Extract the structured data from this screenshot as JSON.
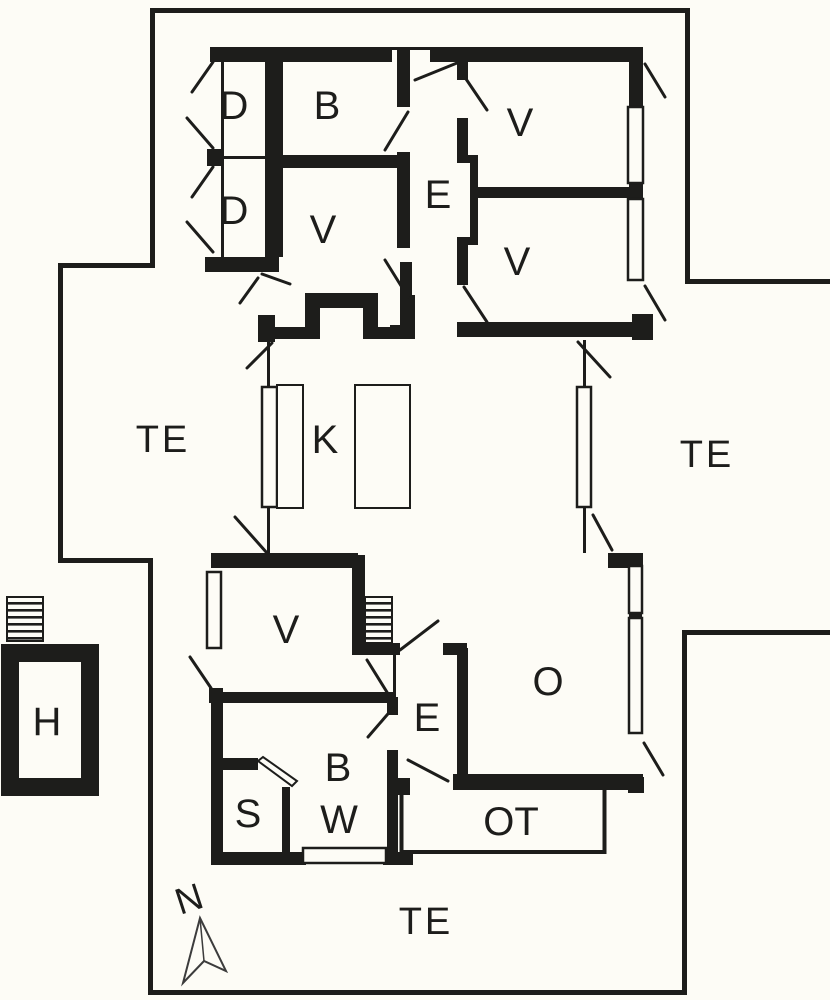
{
  "colors": {
    "ink": "#1d1d1b",
    "paper": "#fdfcf6"
  },
  "compass": {
    "label": "N"
  },
  "rooms": [
    {
      "key": "d1",
      "label": "D"
    },
    {
      "key": "d2",
      "label": "D"
    },
    {
      "key": "b1",
      "label": "B"
    },
    {
      "key": "v1",
      "label": "V"
    },
    {
      "key": "e1",
      "label": "E"
    },
    {
      "key": "v2",
      "label": "V"
    },
    {
      "key": "v3",
      "label": "V"
    },
    {
      "key": "te_west",
      "label": "TE"
    },
    {
      "key": "k",
      "label": "K"
    },
    {
      "key": "te_east",
      "label": "TE"
    },
    {
      "key": "v4",
      "label": "V"
    },
    {
      "key": "o",
      "label": "O"
    },
    {
      "key": "e2",
      "label": "E"
    },
    {
      "key": "b2",
      "label": "B"
    },
    {
      "key": "w",
      "label": "W"
    },
    {
      "key": "s",
      "label": "S"
    },
    {
      "key": "ot",
      "label": "OT"
    },
    {
      "key": "te_south",
      "label": "TE"
    },
    {
      "key": "h",
      "label": "H"
    }
  ]
}
